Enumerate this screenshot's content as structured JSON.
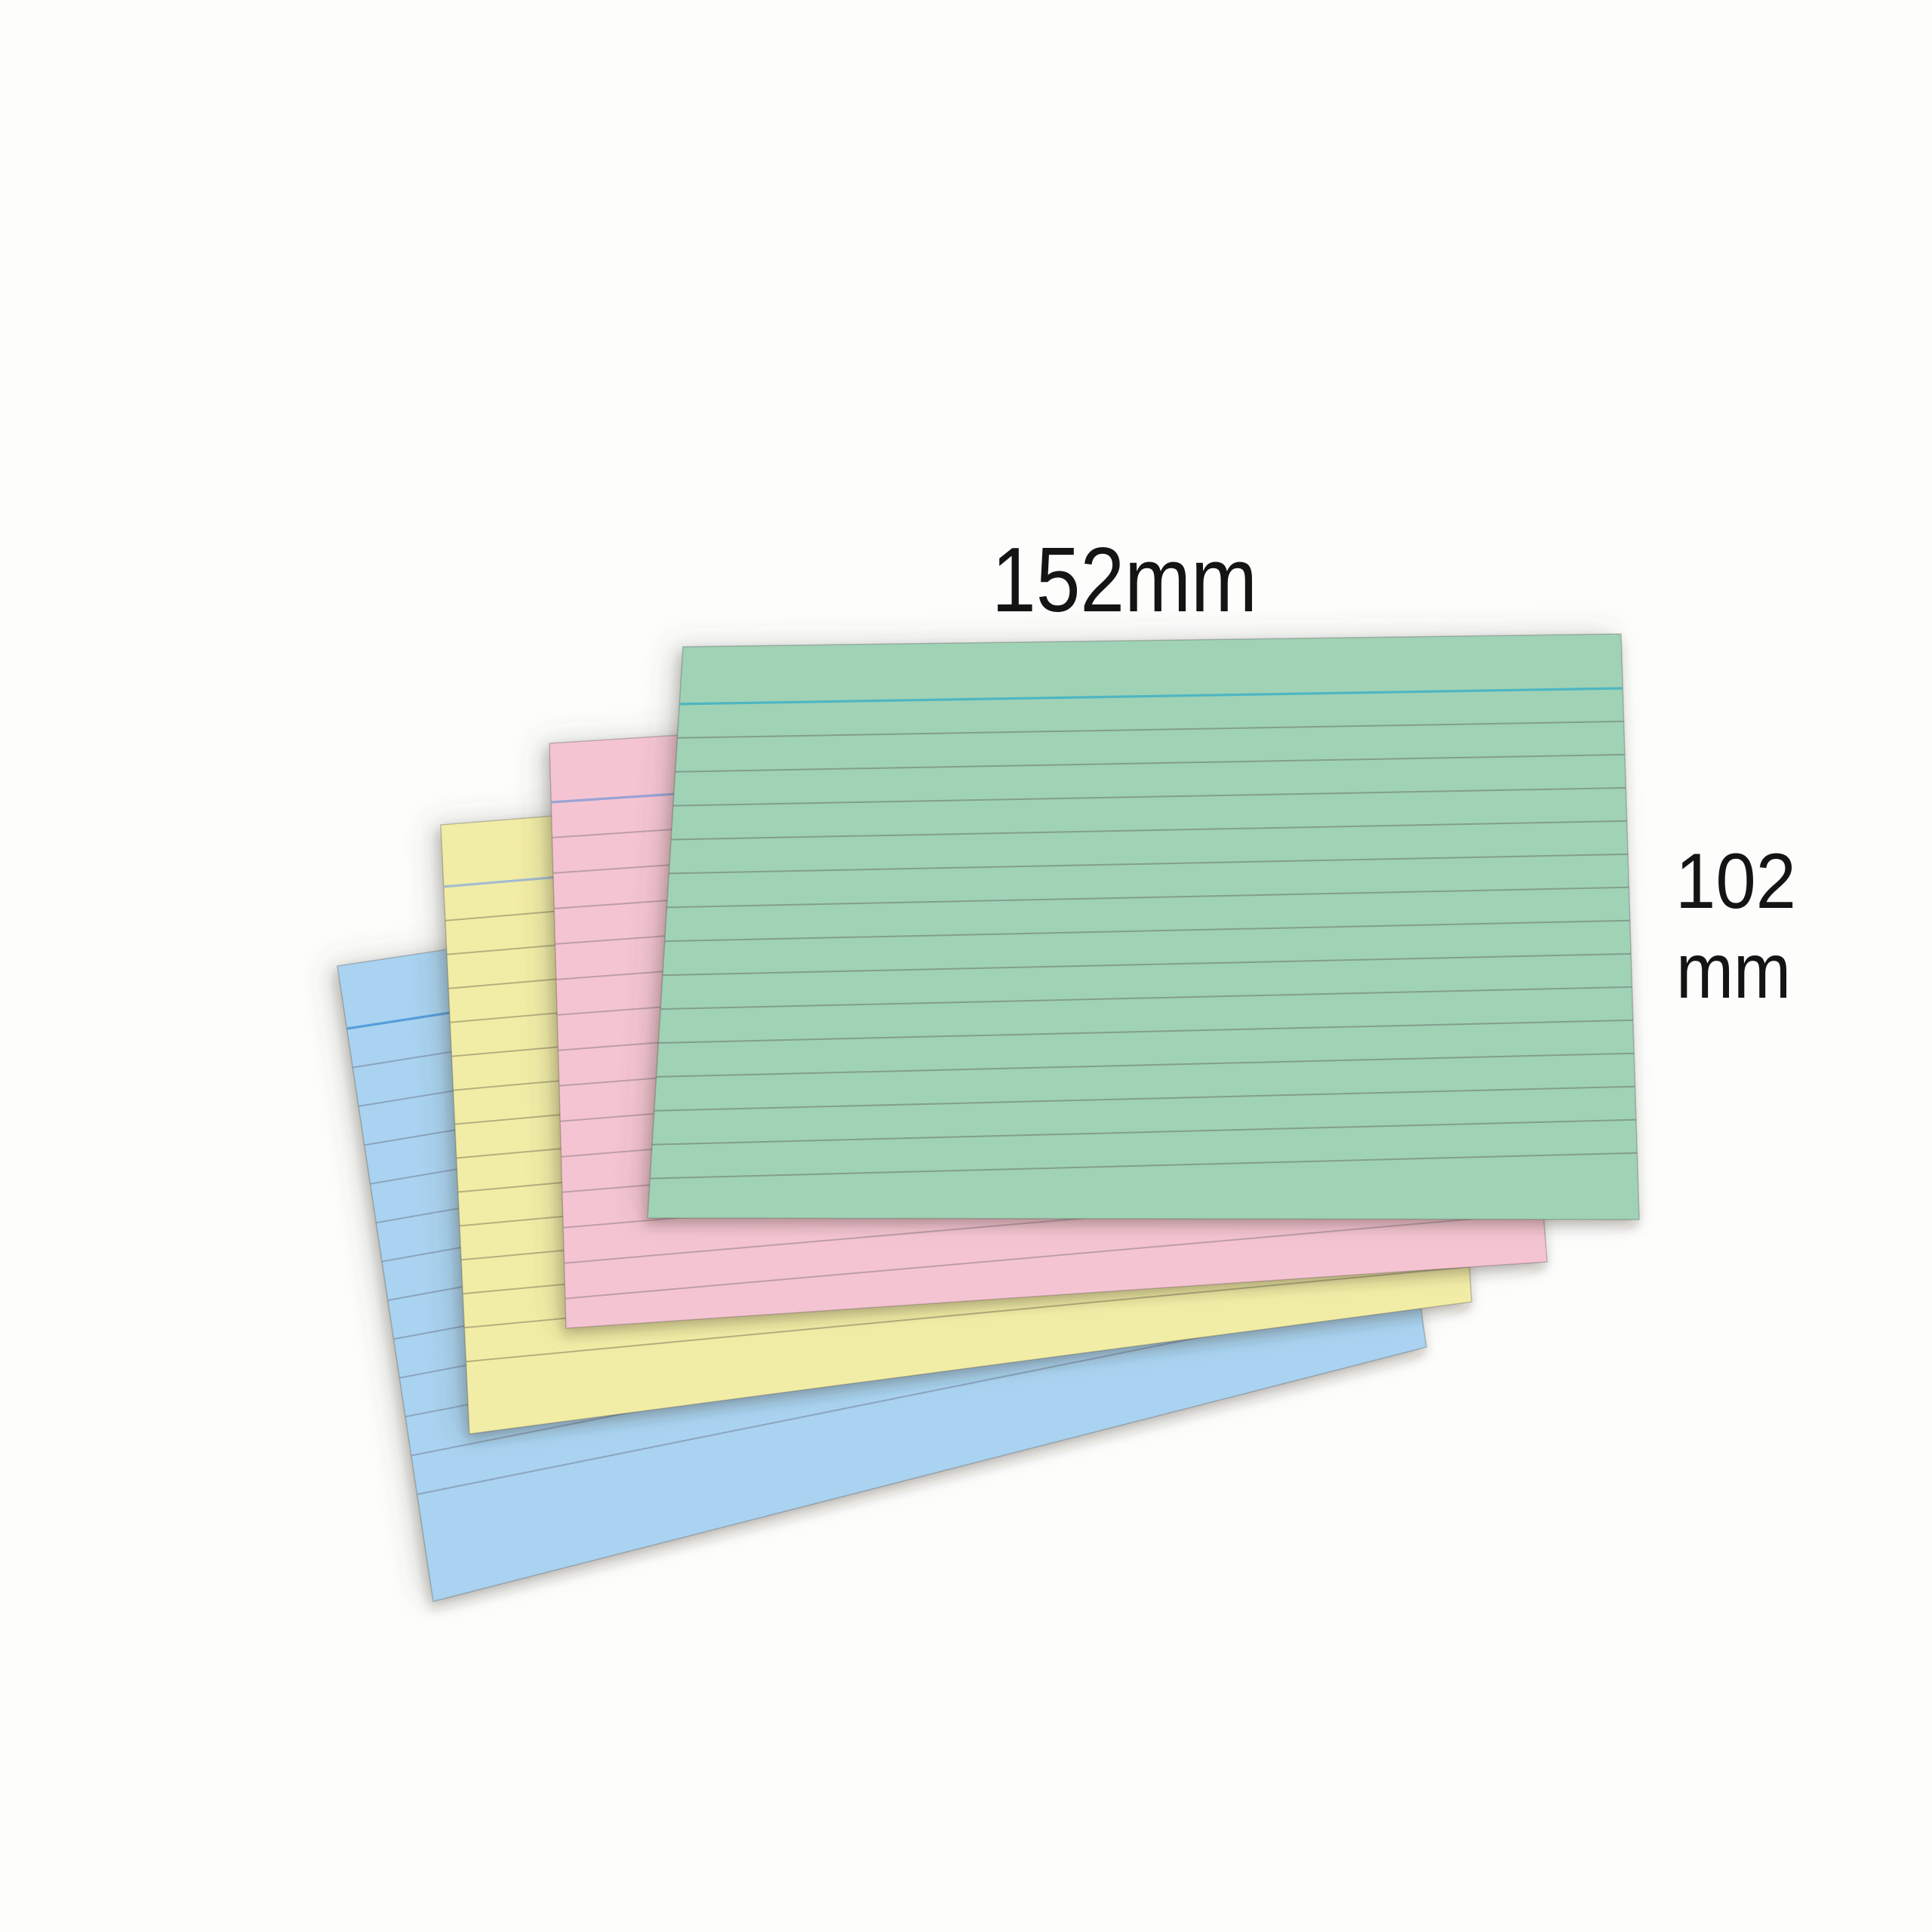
{
  "image_type": "product-photo of ruled index cards",
  "background_color": "#fdfdfc",
  "text_color": "#141414",
  "labels": {
    "width": "152mm",
    "height_value": "102",
    "height_unit": "mm"
  },
  "card_count": 4,
  "cards": [
    {
      "name": "blue-card",
      "color_name": "blue",
      "fill": "#a9d3f0",
      "header_line_color": "#4f9bd9",
      "rule_line_color": "#7a87a0"
    },
    {
      "name": "yellow-card",
      "color_name": "yellow",
      "fill": "#f2eda6",
      "header_line_color": "#9fb9d2",
      "rule_line_color": "#8f8a68"
    },
    {
      "name": "pink-card",
      "color_name": "pink",
      "fill": "#f5c4d2",
      "header_line_color": "#93a1d6",
      "rule_line_color": "#9c8690"
    },
    {
      "name": "green-card",
      "color_name": "green",
      "fill": "#a0d2b6",
      "header_line_color": "#49b4c2",
      "rule_line_color": "#6f8076"
    }
  ]
}
